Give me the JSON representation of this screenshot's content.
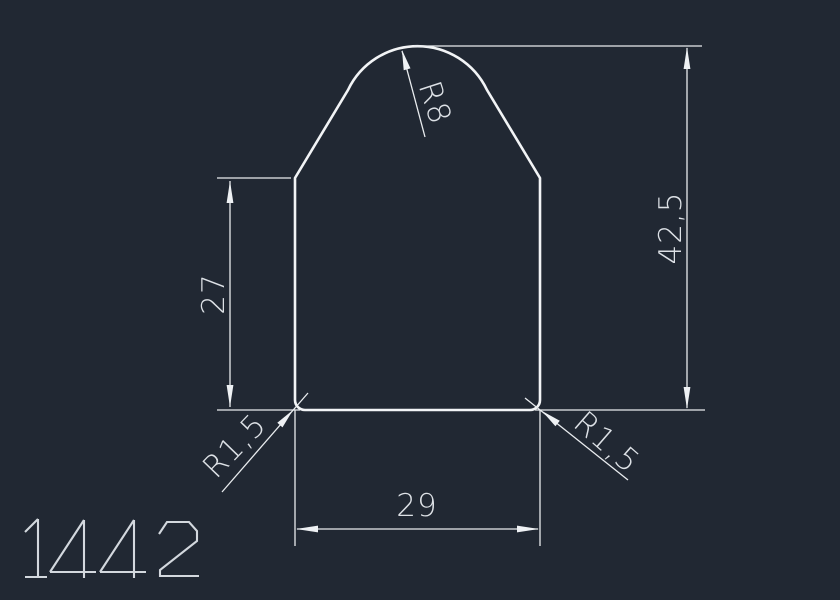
{
  "canvas": {
    "background_color": "#212833",
    "line_color": "#f2f4f6",
    "text_color": "#dde1e6"
  },
  "drawing": {
    "number": "1442",
    "labels": {
      "total_height": "42,5",
      "lower_height": "27",
      "bottom_width": "29",
      "top_radius": "R8",
      "corner_radius_left": "R1,5",
      "corner_radius_right": "R1,5"
    }
  }
}
